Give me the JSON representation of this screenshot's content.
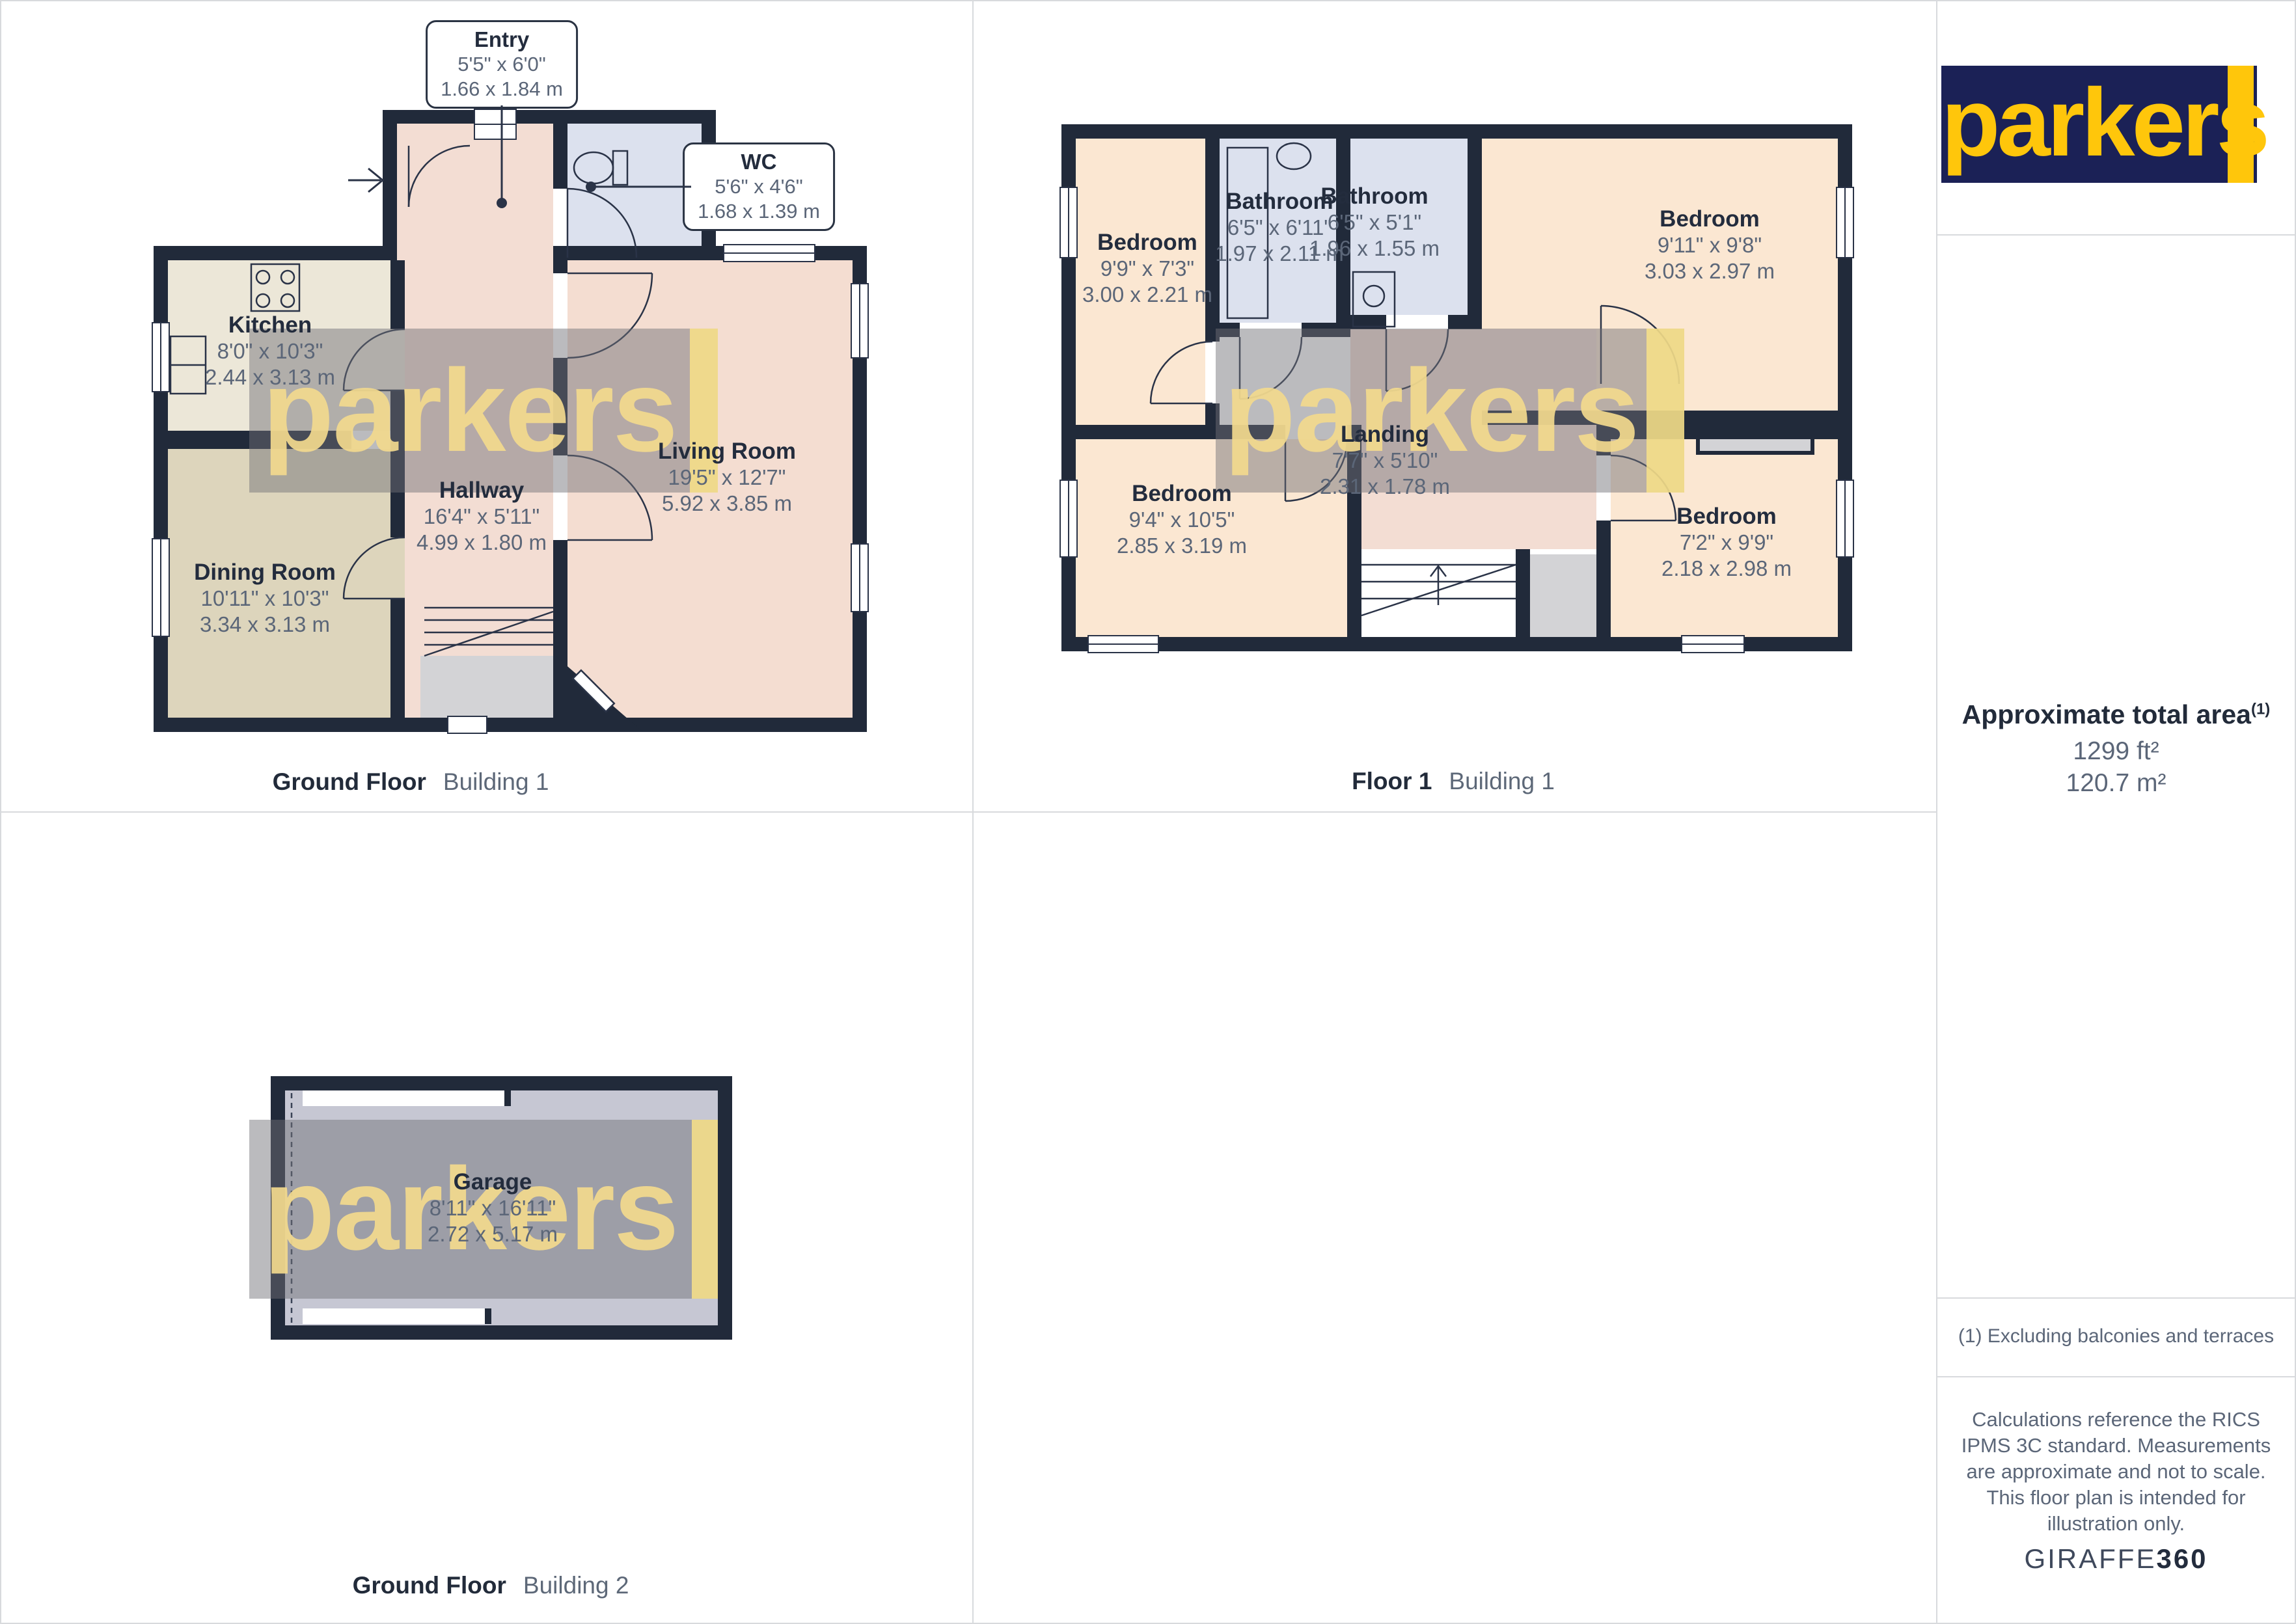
{
  "brand": {
    "logo_text": "parkers",
    "watermark_text": "parkers",
    "logo_navy": "#1B2156",
    "logo_yellow": "#FFC60B"
  },
  "captions": {
    "ground_floor_b1": {
      "floor": "Ground Floor",
      "building": "Building 1"
    },
    "floor1_b1": {
      "floor": "Floor 1",
      "building": "Building 1"
    },
    "ground_floor_b2": {
      "floor": "Ground Floor",
      "building": "Building 2"
    }
  },
  "rooms": {
    "entry": {
      "name": "Entry",
      "imperial": "5'5\" x 6'0\"",
      "metric": "1.66 x 1.84 m"
    },
    "wc": {
      "name": "WC",
      "imperial": "5'6\" x 4'6\"",
      "metric": "1.68 x 1.39 m"
    },
    "kitchen": {
      "name": "Kitchen",
      "imperial": "8'0\" x 10'3\"",
      "metric": "2.44 x 3.13 m"
    },
    "dining": {
      "name": "Dining Room",
      "imperial": "10'11\" x 10'3\"",
      "metric": "3.34 x 3.13 m"
    },
    "hallway": {
      "name": "Hallway",
      "imperial": "16'4\" x 5'11\"",
      "metric": "4.99 x 1.80 m"
    },
    "living": {
      "name": "Living Room",
      "imperial": "19'5\" x 12'7\"",
      "metric": "5.92 x 3.85 m"
    },
    "bedroom_tl": {
      "name": "Bedroom",
      "imperial": "9'9\" x 7'3\"",
      "metric": "3.00 x 2.21 m"
    },
    "bathroom_1": {
      "name": "Bathroom",
      "imperial": "6'5\" x 6'11\"",
      "metric": "1.97 x 2.11 m"
    },
    "bathroom_2": {
      "name": "Bathroom",
      "imperial": "6'5\" x 5'1\"",
      "metric": "1.96 x 1.55 m"
    },
    "bedroom_tr": {
      "name": "Bedroom",
      "imperial": "9'11\" x 9'8\"",
      "metric": "3.03 x 2.97 m"
    },
    "bedroom_bl": {
      "name": "Bedroom",
      "imperial": "9'4\" x 10'5\"",
      "metric": "2.85 x 3.19 m"
    },
    "landing": {
      "name": "Landing",
      "imperial": "7'7\" x 5'10\"",
      "metric": "2.31 x 1.78 m"
    },
    "bedroom_br": {
      "name": "Bedroom",
      "imperial": "7'2\" x 9'9\"",
      "metric": "2.18 x 2.98 m"
    },
    "garage": {
      "name": "Garage",
      "imperial": "8'11\" x 16'11\"",
      "metric": "2.72 x 5.17 m"
    }
  },
  "sidebar": {
    "area_title": "Approximate total area",
    "area_superscript": "(1)",
    "area_ft": "1299 ft²",
    "area_m": "120.7 m²",
    "footnote": "(1) Excluding balconies and terraces",
    "disclaimer": "Calculations reference the RICS IPMS 3C standard. Measurements are approximate and not to scale. This floor plan is intended for illustration only.",
    "brand_left": "GIRAFFE",
    "brand_right": "360"
  },
  "palette": {
    "wall": "#212A3A",
    "hall_pink": "#F3DDD3",
    "bath_blue": "#DCE1EE",
    "kitchen_cream": "#ECE7D8",
    "dining_tan": "#DDD5BC",
    "living_peach": "#F4DDD1",
    "bedroom_peach": "#FBE7D2",
    "garage_lavender": "#C6C7D3",
    "closet_gray": "#D3D3D6",
    "watermark_yellow": "#F3DA8E"
  }
}
